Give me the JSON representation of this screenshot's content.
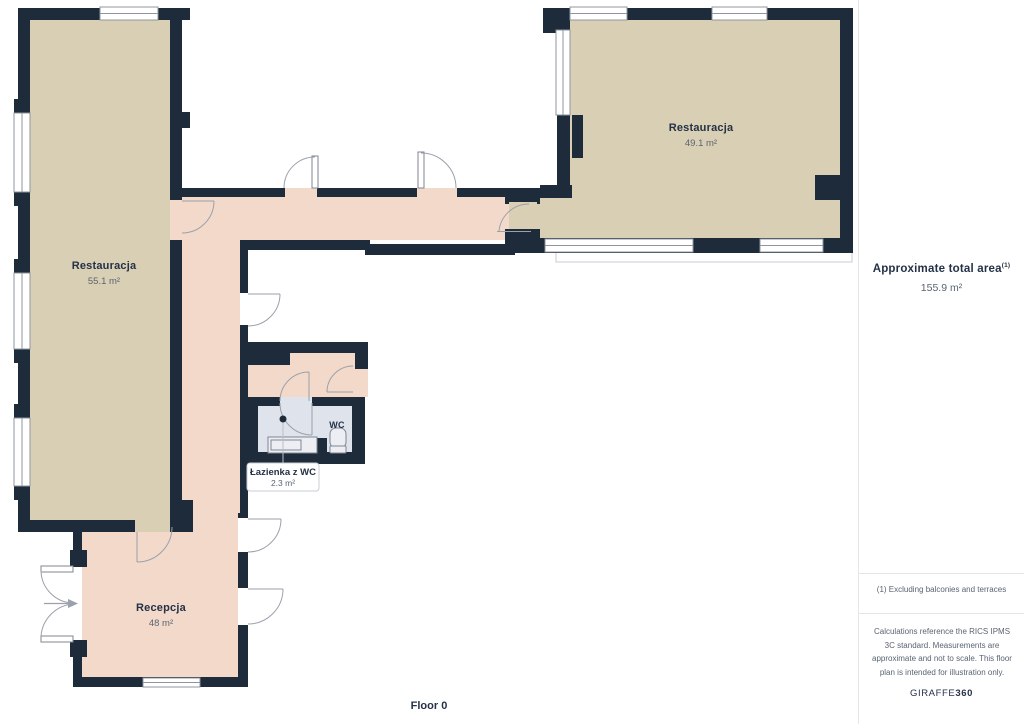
{
  "floor_plan": {
    "floor_label": "Floor 0",
    "rooms": [
      {
        "name": "Restauracja",
        "area": "55.1 m²"
      },
      {
        "name": "Restauracja",
        "area": "49.1 m²"
      },
      {
        "name": "Recepcja",
        "area": "48 m²"
      },
      {
        "name": "Łazienka z WC",
        "area": "2.3 m²"
      }
    ],
    "wc_label": "WC",
    "colors": {
      "wall": "#1e2b3b",
      "floor_tan": "#d9cfb4",
      "floor_pink": "#f3d9ca",
      "floor_wc": "#dfe3ec",
      "door_line": "#9aa1ab",
      "leaf_stroke": "#80868f",
      "window_line": "#8f969f",
      "leader_line": "#b9bfc7",
      "terrace_line": "#c5cbd3",
      "callout_border": "#c9cdd4",
      "text_primary": "#243147",
      "text_secondary": "#5a6472"
    }
  },
  "sidebar": {
    "total_area_label": "Approximate total area",
    "total_area_superscript": "(1)",
    "total_area_value": "155.9 m²",
    "footnote": "(1) Excluding balconies and terraces",
    "disclaimer": "Calculations reference the RICS IPMS 3C standard. Measurements are approximate and not to scale. This floor plan is intended for illustration only.",
    "brand": {
      "name": "GIRAFFE",
      "suffix": "360"
    }
  }
}
